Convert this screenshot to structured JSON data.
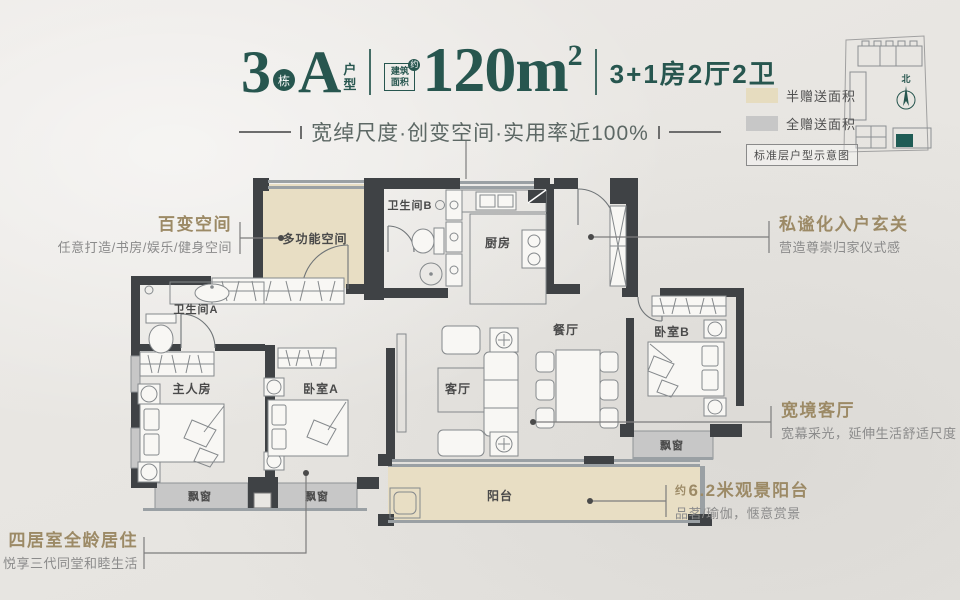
{
  "header": {
    "block_number": "3",
    "block_label": "栋",
    "unit_letter": "A",
    "unit_label_1": "户",
    "unit_label_2": "型",
    "area_badge_1": "建筑",
    "area_badge_2": "面积",
    "area_badge_approx": "约",
    "area_value": "120m",
    "area_exponent": "2",
    "layout_spec": "3+1房2厅2卫",
    "tagline": "宽绰尺度·创变空间·实用率近100%"
  },
  "legend": {
    "items": [
      {
        "label": "半赠送面积",
        "color": "#e6dcbf"
      },
      {
        "label": "全赠送面积",
        "color": "#c7c7c7"
      }
    ],
    "note": "标准层户型示意图",
    "north": "北"
  },
  "rooms": {
    "multi_function": "多功能空间",
    "bathroom_b": "卫生间B",
    "kitchen": "厨房",
    "bathroom_a": "卫生间A",
    "master_bedroom": "主人房",
    "bedroom_a": "卧室A",
    "living_room": "客厅",
    "dining_room": "餐厅",
    "bedroom_b": "卧室B",
    "balcony": "阳台",
    "bay_window": "飘窗"
  },
  "callouts": {
    "flex_space": {
      "title": "百变空间",
      "desc": "任意打造/书房/娱乐/健身空间"
    },
    "entry": {
      "title": "私谧化入户玄关",
      "desc": "营造尊崇归家仪式感"
    },
    "living": {
      "title": "宽境客厅",
      "desc": "宽幕采光，延伸生活舒适尺度"
    },
    "balcony": {
      "approx": "约",
      "title": "6.2米观景阳台",
      "desc": "品茗/瑜伽，惬意赏景"
    },
    "family": {
      "title": "四居室全龄居住",
      "desc": "悦享三代同堂和睦生活"
    }
  },
  "colors": {
    "accent_teal": "#27564f",
    "callout_gold": "#9c8a66",
    "half_gift_fill": "#e8dec4",
    "full_gift_fill": "#c7c7c7",
    "wall": "#3f4245"
  }
}
